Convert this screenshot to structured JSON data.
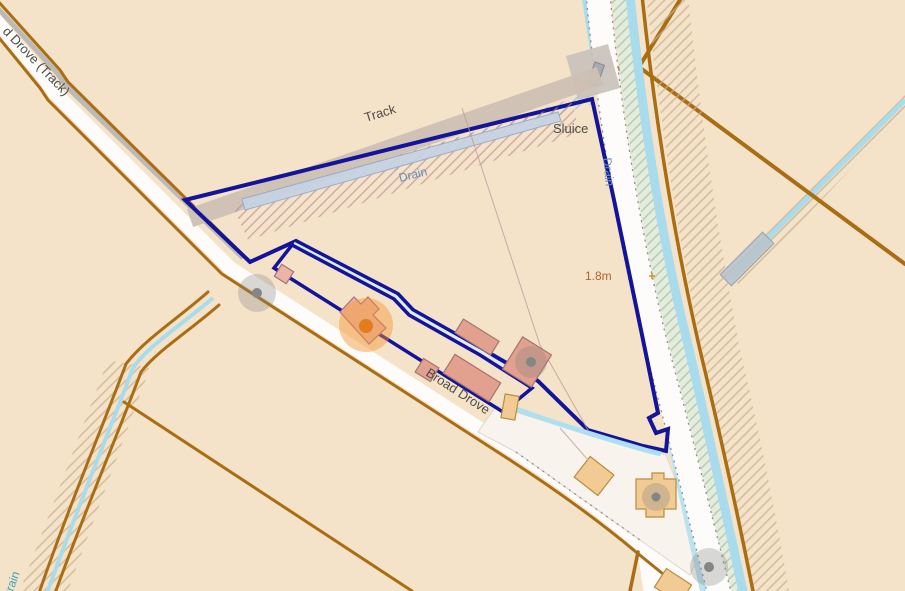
{
  "map": {
    "type": "topographic-map-with-land-parcel-overlay",
    "labels": {
      "road_top_left": "d Drove (Track)",
      "track": "Track",
      "drain_field": "Drain",
      "drain_right": "Drain",
      "drain_bottom_left": "Drain",
      "sluice": "Sluice",
      "spot_height": "1.8m",
      "broad_drove": "Broad Drove"
    },
    "colors": {
      "background": "#f5e3c9",
      "parcel_outline": "#14149b",
      "parcel_fill_pink": "rgba(170,62,110,0.40)",
      "parcel_fill_purple": "#ddc7df",
      "road_fill": "#fdfcfa",
      "boundary_brown": "#a96d13",
      "water_blue": "#a8dcec",
      "building_salmon": "#e2a18f",
      "building_orange": "#f2cb94",
      "label_water": "#6b8cba",
      "label_spot": "#b0622e",
      "label_dark": "#4c4c46",
      "poi_orange": "rgba(243,148,50,0.45)"
    },
    "markers": {
      "orange_poi_count": 1,
      "gray_poi_count": 4,
      "benchmark_cross_count": 1
    }
  }
}
